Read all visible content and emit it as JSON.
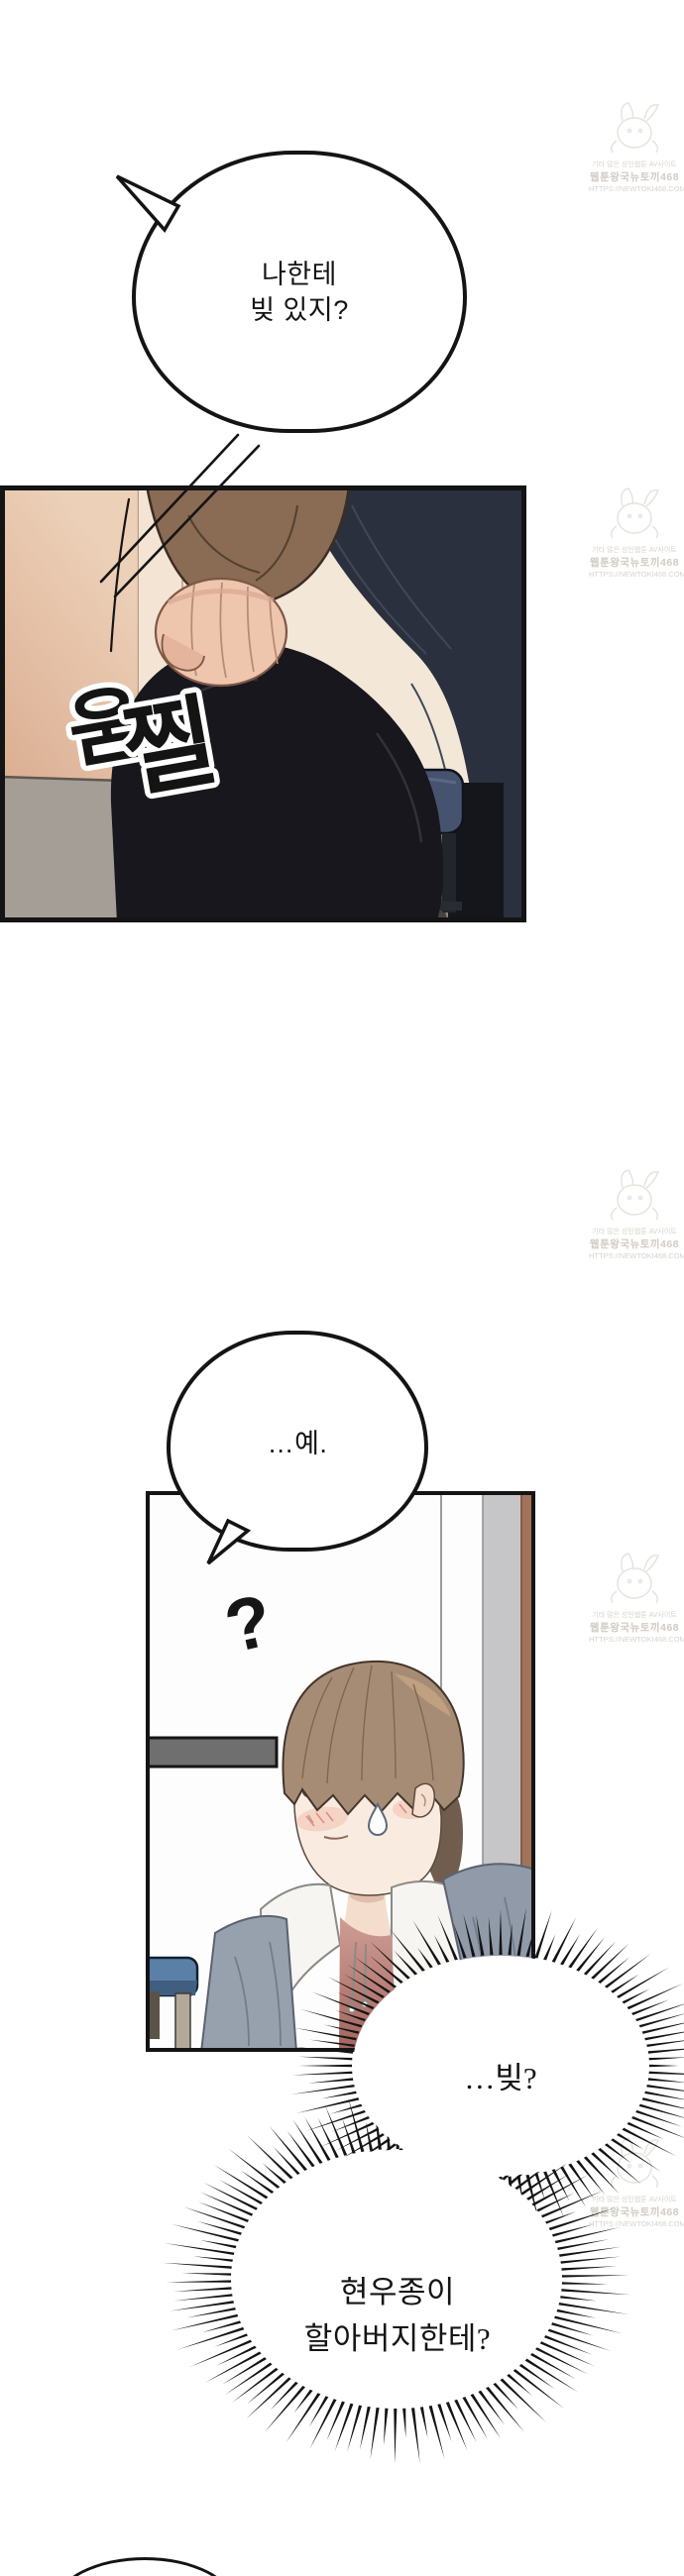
{
  "watermark": {
    "line1": "기타 많은 성인웹툰 AV사이트",
    "line2": "웹툰왕국뉴토끼468",
    "line3": "HTTPS://NEWTOKI468.COM"
  },
  "bubbles": {
    "b1": {
      "text": "나한테\n빚 있지?"
    },
    "b2": {
      "text": "…예."
    },
    "b3": {
      "text": "…빚?"
    },
    "b4": {
      "text": "현우종이\n할아버지한테?"
    }
  },
  "sfx": {
    "flinch_char_1": "움",
    "flinch_char_2": "찔",
    "question_mark": "?"
  },
  "colors": {
    "outline": "#141414",
    "wall_peach": "#d9ab8e",
    "wall_cream": "#f3e7d7",
    "floor_gray": "#a49e97",
    "jacket_brown": "#8a6b53",
    "pants_black": "#17171d",
    "figure_navy": "#2a303d",
    "stool_navy": "#46536f",
    "stool_blue": "#5b80a8",
    "skin": "#eec6ae",
    "hair_brown": "#a78c75",
    "hoodie_gray": "#97a1ae",
    "hood_white": "#f7f5f1",
    "shirt_maroon": "#a2645e",
    "door_gray_strip": "#c6c6c8",
    "door_brown_strip": "#a0735a"
  }
}
